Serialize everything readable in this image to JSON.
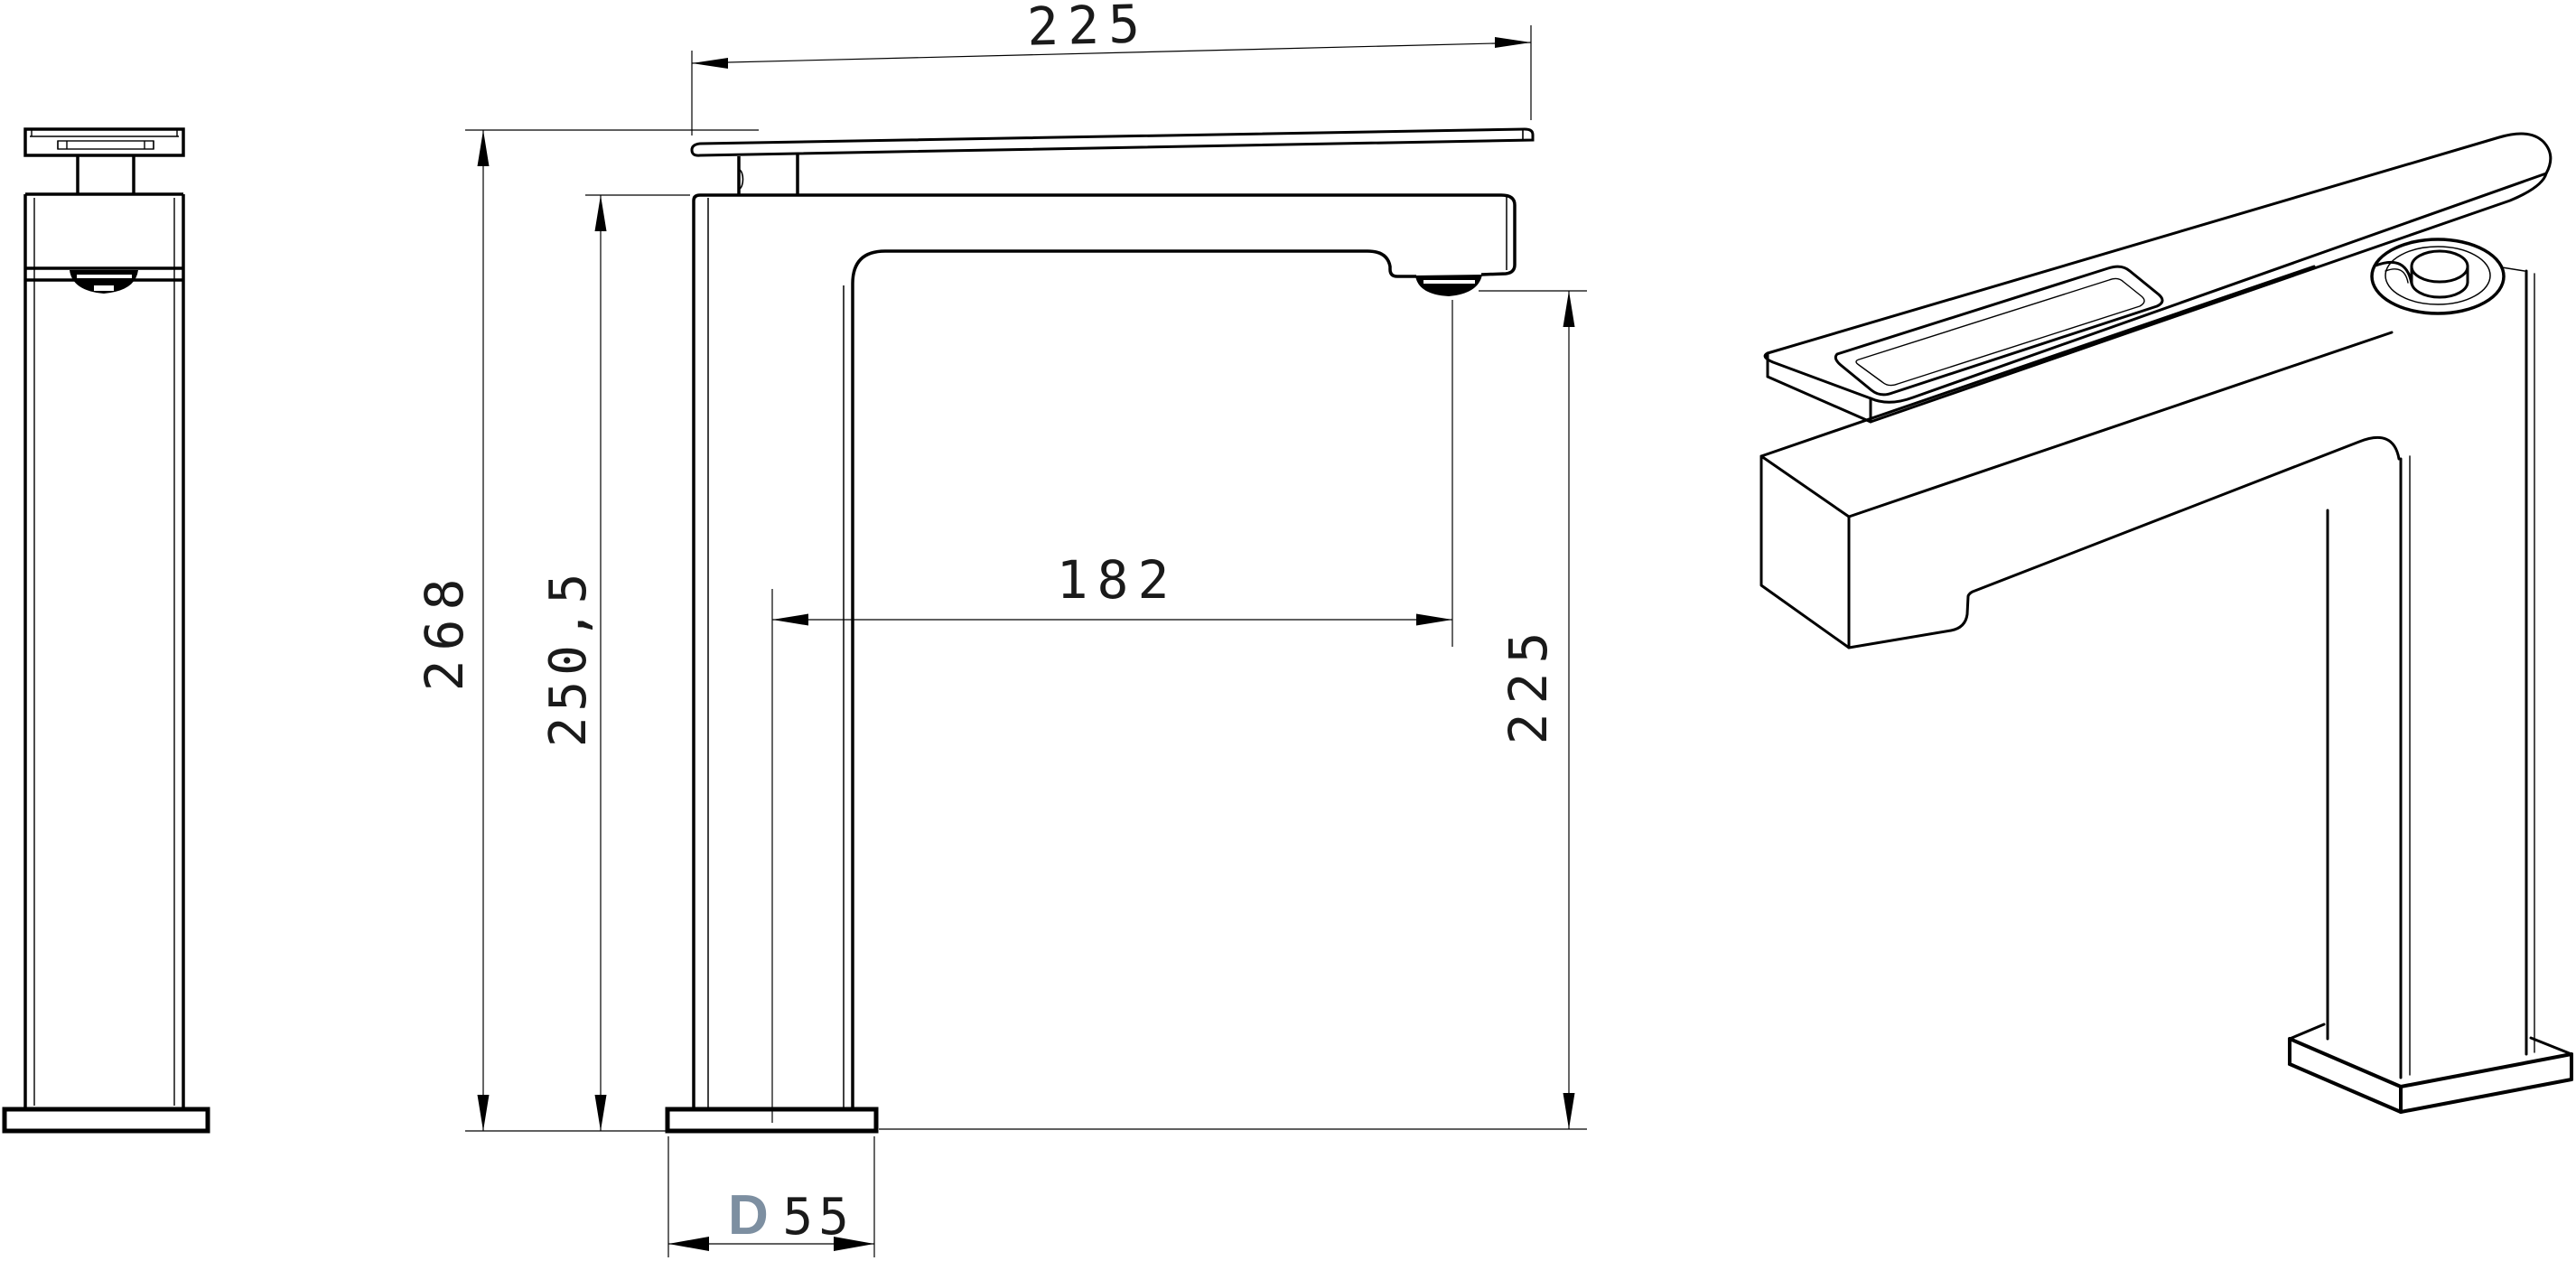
{
  "drawing": {
    "description": "Technical dimension drawing of a tall single-lever basin mixer faucet, three views: side elevation, front elevation with dimensions, isometric view",
    "units": "mm",
    "colors": {
      "line": "#000000",
      "background": "#ffffff",
      "diameter_prefix": "#7d8fa1"
    },
    "dimensions": {
      "handle_length": {
        "label": "225",
        "value": 225,
        "orientation": "horizontal-top"
      },
      "total_height": {
        "label": "268",
        "value": 268,
        "orientation": "vertical-left"
      },
      "body_height": {
        "label": "250,5",
        "value": 250.5,
        "orientation": "vertical-left-inner"
      },
      "spout_reach": {
        "label": "182",
        "value": 182,
        "orientation": "horizontal-middle"
      },
      "spout_height": {
        "label": "225",
        "value": 225,
        "orientation": "vertical-right"
      },
      "base_diameter": {
        "prefix": "D",
        "size": "55",
        "label": "D55",
        "value": 55,
        "orientation": "horizontal-bottom"
      }
    }
  }
}
